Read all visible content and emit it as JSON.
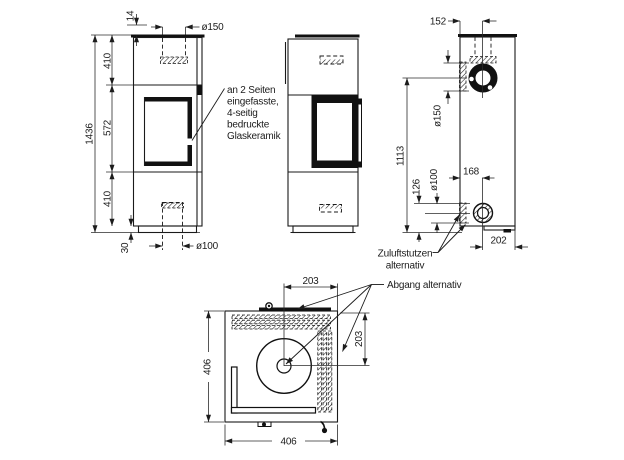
{
  "colors": {
    "line": "#1c1c1c",
    "background": "#ffffff"
  },
  "front_view": {
    "dims": {
      "total_height": "1436",
      "top_plate": "14",
      "upper_section": "410",
      "window_section": "572",
      "lower_section": "410",
      "base_height": "30",
      "flue_diameter": "ø150",
      "air_inlet_diameter": "ø100"
    }
  },
  "rear_view": {
    "dims": {
      "flue_offset_top": "152",
      "flue_diameter_side": "ø150",
      "flue_center_height": "1113",
      "air_inlet_height": "126",
      "air_inlet_diameter_side": "ø100",
      "air_center_from_left": "168",
      "air_center_to_right": "202"
    }
  },
  "top_view": {
    "dims": {
      "flue_center_x": "203",
      "flue_center_y": "203",
      "width": "406",
      "depth": "406"
    }
  },
  "notes": {
    "glass": {
      "line1": "an 2 Seiten",
      "line2": "eingefasste,",
      "line3": "4-seitig",
      "line4": "bedruckte",
      "line5": "Glaskeramik"
    },
    "zuluft": {
      "line1": "Zuluftstutzen",
      "line2": "alternativ"
    },
    "abgang": {
      "line1": "Abgang alternativ"
    }
  }
}
